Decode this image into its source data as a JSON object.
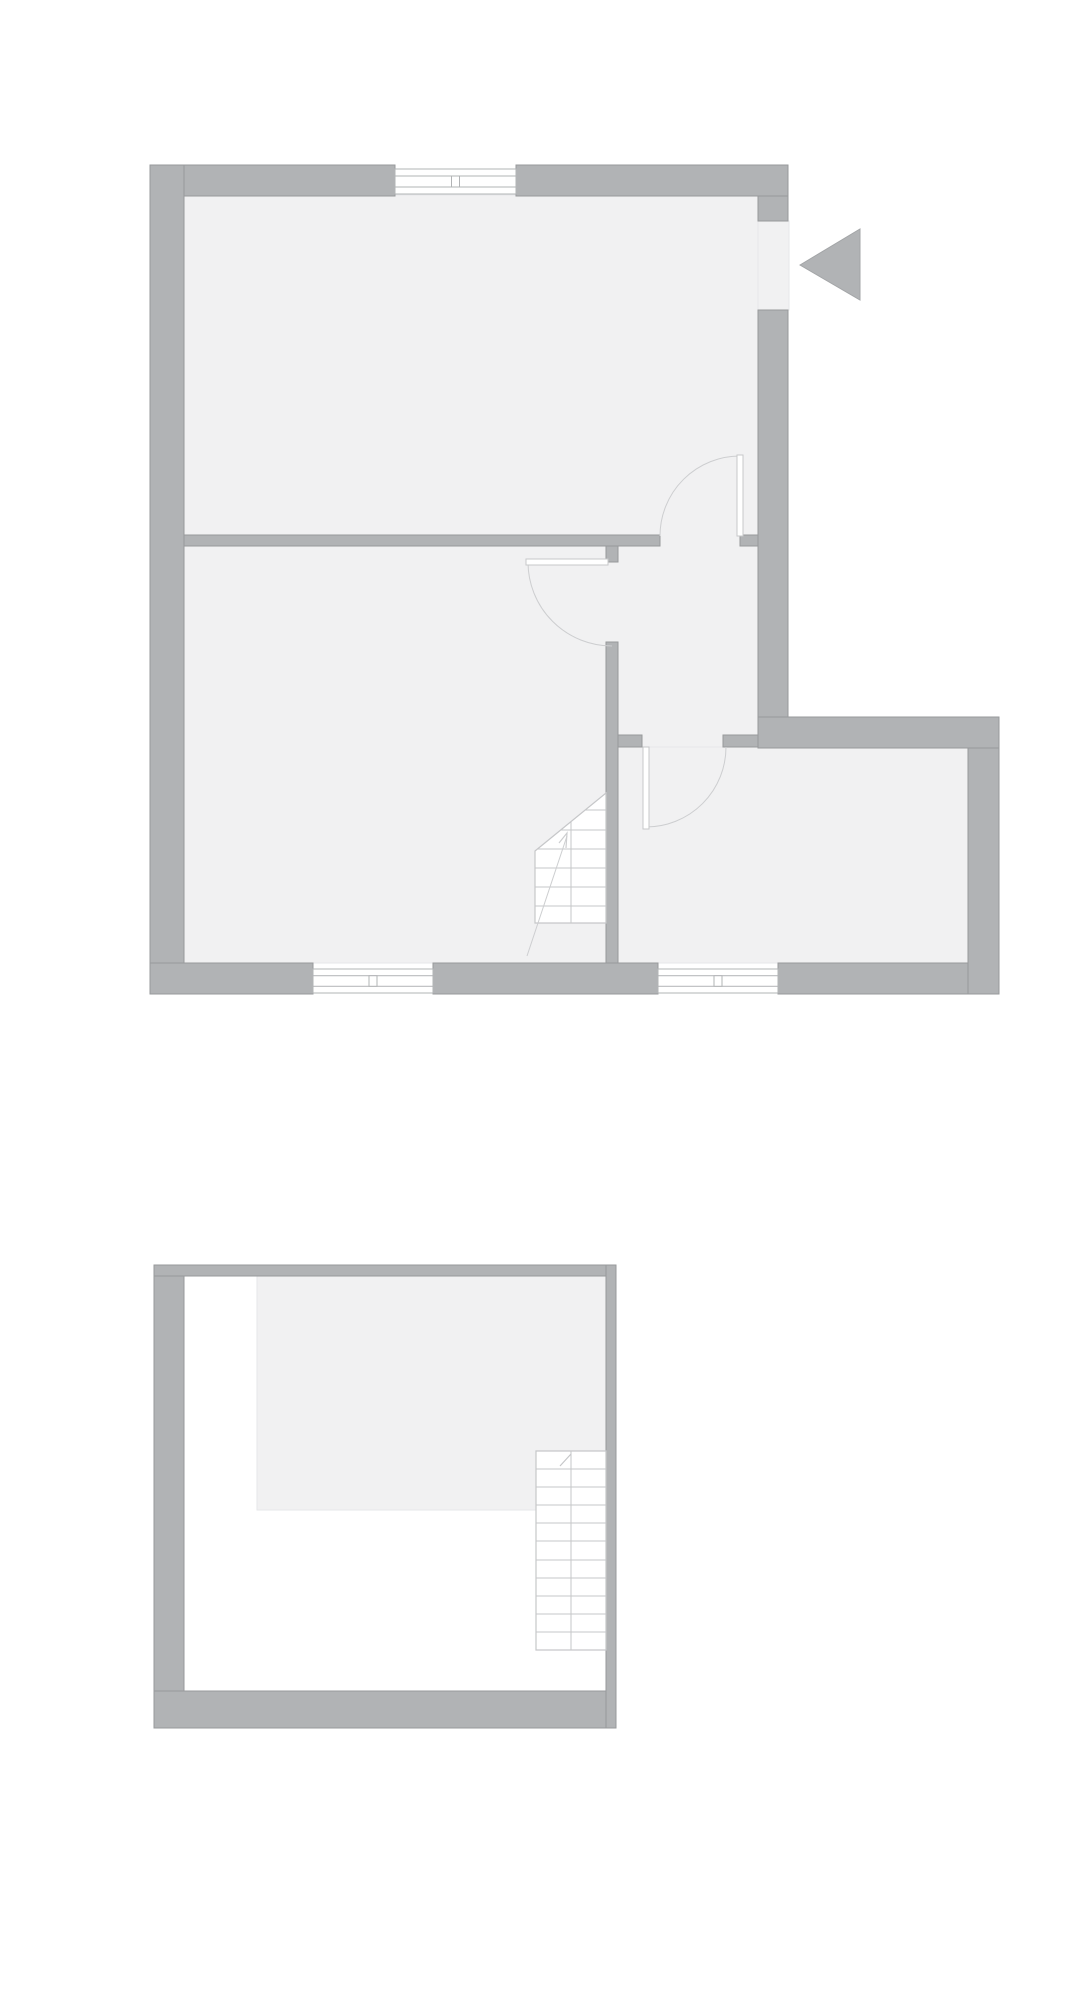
{
  "canvas": {
    "width": 1090,
    "height": 2000,
    "background": "#ffffff"
  },
  "palette": {
    "white": "#ffffff",
    "wall_fill": "#b1b3b5",
    "wall_stroke": "#97999b",
    "floor_fill": "#f1f1f2",
    "faint_line": "#e6e7e9",
    "stair_line": "#c6c7c9",
    "door_line": "#cdced0",
    "door_leaf_stroke": "#c7c8ca",
    "window_line": "#b2b4b6",
    "arrow_stroke": "#a3a5a7"
  },
  "floors": [
    {
      "id": "ground-floor-plan",
      "floor_areas": [
        [
          184,
          195,
          574,
          768
        ],
        [
          617,
          747,
          351,
          216
        ],
        [
          758,
          221,
          31,
          89
        ]
      ],
      "thick_walls": [
        [
          150,
          165,
          245,
          31
        ],
        [
          516,
          165,
          272,
          31
        ],
        [
          150,
          165,
          34,
          829
        ],
        [
          150,
          963,
          163,
          31
        ],
        [
          433,
          963,
          225,
          31
        ],
        [
          778,
          963,
          221,
          31
        ],
        [
          758,
          196,
          30,
          25
        ],
        [
          758,
          310,
          30,
          407
        ],
        [
          758,
          717,
          241,
          31
        ],
        [
          968,
          748,
          31,
          246
        ]
      ],
      "thin_walls": [
        [
          184,
          535,
          476,
          11
        ],
        [
          740,
          535,
          18,
          11
        ],
        [
          606,
          546,
          12,
          16
        ],
        [
          606,
          642,
          12,
          321
        ],
        [
          618,
          735,
          24,
          12
        ],
        [
          723,
          735,
          35,
          12
        ]
      ],
      "windows": [
        [
          395,
          169,
          121,
          25
        ],
        [
          313,
          969,
          120,
          24
        ],
        [
          658,
          969,
          120,
          24
        ]
      ],
      "doors": [
        {
          "leaf": [
            737,
            455,
            6,
            81
          ],
          "arc": "M660,536 A80,80 0 0 1 740,456"
        },
        {
          "leaf": [
            526,
            559,
            82,
            6
          ],
          "arc": "M528,562 A84,84 0 0 0 612,646"
        },
        {
          "leaf": [
            643,
            747,
            6,
            82
          ],
          "arc": "M646,827 A80,80 0 0 0 726,747"
        }
      ],
      "stairs": [
        {
          "x1": 535,
          "x2": 606,
          "outline": "535,851 606,793 606,923 535,923",
          "treads": [
            810,
            830,
            849,
            868,
            887,
            906
          ],
          "divider": [
            571,
            793,
            923
          ],
          "walk": [
            527,
            956,
            567,
            836
          ],
          "arrow_head": "559,843 567,833 566,848"
        }
      ],
      "entrance_arrow": "800,265 860,229 860,300"
    },
    {
      "id": "upper-floor-plan",
      "floor_areas_white": [
        [
          184,
          1276,
          422,
          415
        ]
      ],
      "floor_areas": [
        [
          257,
          1276,
          349,
          234
        ]
      ],
      "thick_walls": [
        [
          154,
          1265,
          30,
          463
        ],
        [
          154,
          1691,
          462,
          37
        ]
      ],
      "thin_walls": [
        [
          154,
          1265,
          462,
          11
        ],
        [
          606,
          1265,
          10,
          463
        ]
      ],
      "windows": [],
      "doors": [],
      "stairs": [
        {
          "x1": 536,
          "x2": 606,
          "outline": "536,1451 606,1451 606,1650 536,1650",
          "treads": [
            1469,
            1487,
            1505,
            1523,
            1541,
            1560,
            1578,
            1596,
            1614,
            1632
          ],
          "divider": [
            571,
            1451,
            1650
          ],
          "tick": [
            560,
            1466,
            571,
            1454
          ]
        }
      ]
    }
  ]
}
